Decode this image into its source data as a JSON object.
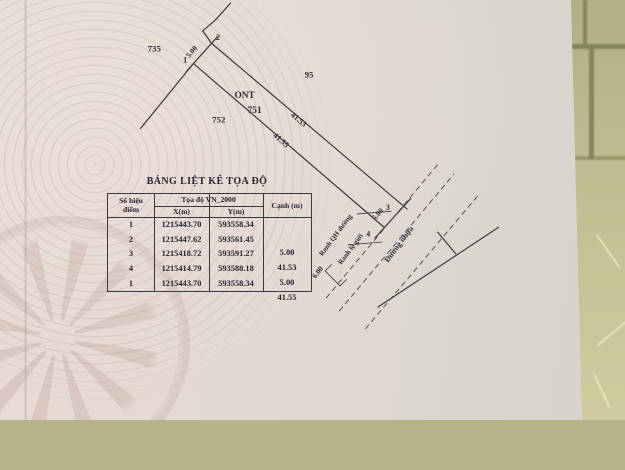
{
  "table": {
    "title": "BẢNG LIỆT KÊ TỌA ĐỘ",
    "headers": {
      "point_line1": "Số hiệu",
      "point_line2": "điểm",
      "coord": "Tọa độ VN_2000",
      "x": "X(m)",
      "y": "Y(m)",
      "edge": "Cạnh (m)"
    },
    "rows": [
      {
        "id": "1",
        "x": "1215443.70",
        "y": "593558.34"
      },
      {
        "id": "2",
        "x": "1215447.62",
        "y": "593561.45"
      },
      {
        "id": "3",
        "x": "1215418.72",
        "y": "593591.27"
      },
      {
        "id": "4",
        "x": "1215414.79",
        "y": "593588.18"
      },
      {
        "id": "1",
        "x": "1215443.70",
        "y": "593558.34"
      }
    ],
    "edges": [
      "5.00",
      "41.53",
      "5.00",
      "41.55"
    ]
  },
  "plot": {
    "point_labels": {
      "p1": "1",
      "p2": "2",
      "p3": "3",
      "p4": "4"
    },
    "dimensions": {
      "left_edge": "5.00",
      "top_edge": "41.53",
      "bottom_edge": "41.55",
      "right_edge": "5.00",
      "setback": "6.00"
    },
    "parcel": {
      "number": "751",
      "land_use": "ONT"
    },
    "neighbors": {
      "left": "735",
      "top": "95",
      "bottom": "752"
    },
    "road": {
      "planning_boundary": "Ranh QH đường",
      "row_boundary": "Ranh lộ giới",
      "surface": "Đường nhựa"
    }
  },
  "colors": {
    "ink": "#34323a",
    "paper": "#e2dad3",
    "tile": "#b7b489"
  }
}
